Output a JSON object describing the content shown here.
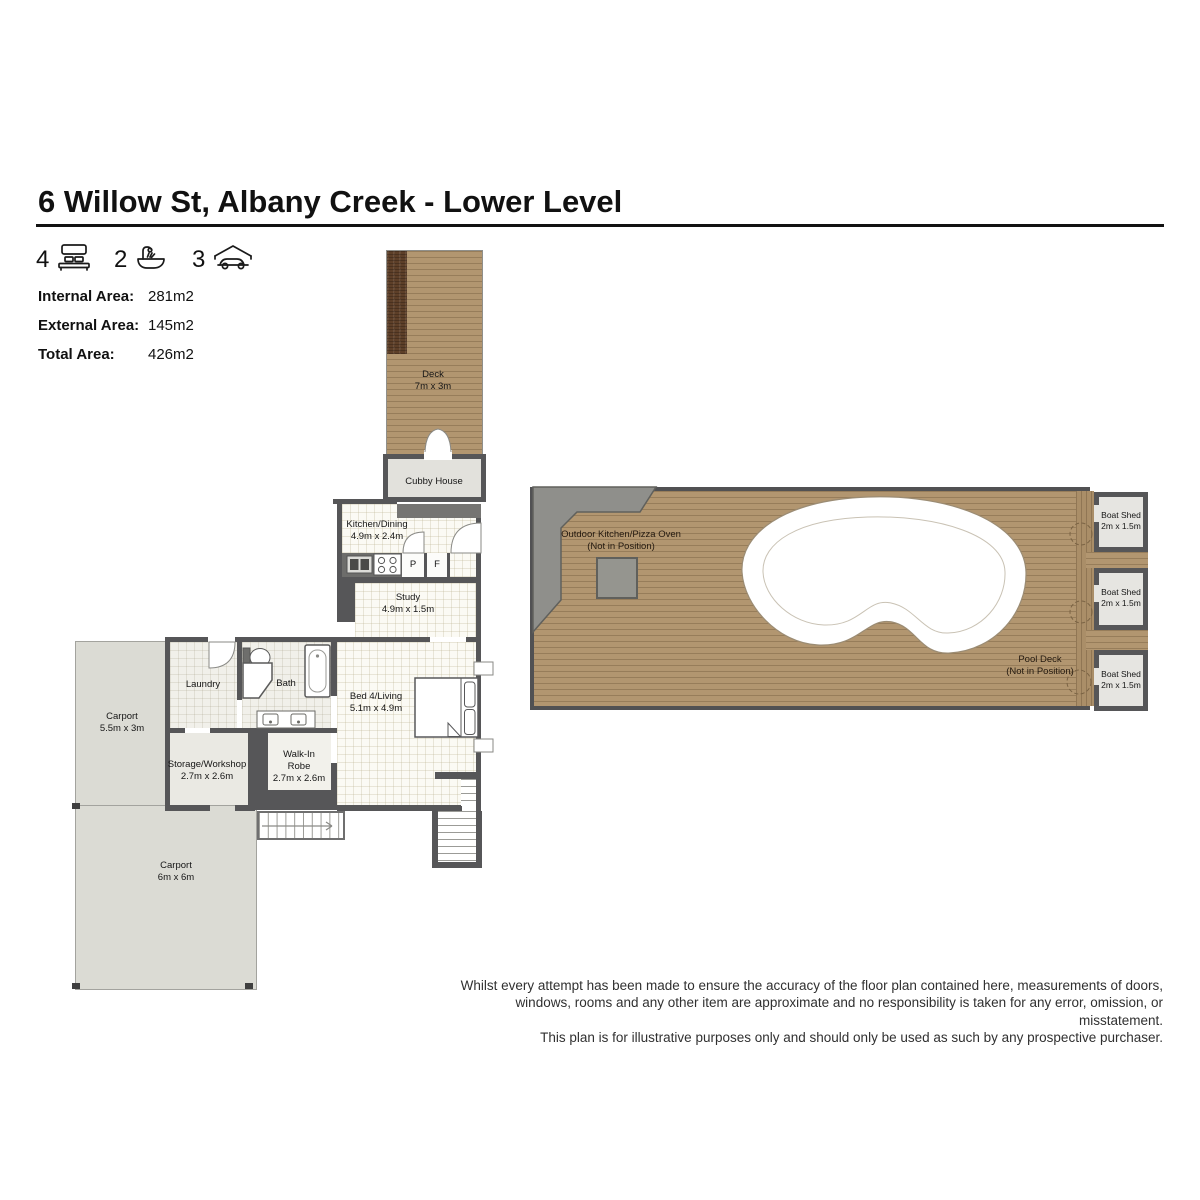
{
  "header": {
    "title": "6 Willow St, Albany Creek - Lower Level"
  },
  "features": [
    {
      "count": "4",
      "type": "bedrooms"
    },
    {
      "count": "2",
      "type": "bathrooms"
    },
    {
      "count": "3",
      "type": "car-spaces"
    }
  ],
  "areas": [
    {
      "label": "Internal Area:",
      "value": "281m2"
    },
    {
      "label": "External Area:",
      "value": "145m2"
    },
    {
      "label": "Total Area:",
      "value": "426m2"
    }
  ],
  "rooms": {
    "deck": {
      "name": "Deck",
      "dims": "7m x 3m"
    },
    "cubby_house": {
      "name": "Cubby House"
    },
    "kitchen_dining": {
      "name": "Kitchen/Dining",
      "dims": "4.9m x 2.4m"
    },
    "pantry_label": "P",
    "fridge_label": "F",
    "study": {
      "name": "Study",
      "dims": "4.9m x 1.5m"
    },
    "laundry": {
      "name": "Laundry"
    },
    "bath": {
      "name": "Bath"
    },
    "carport_upper": {
      "name": "Carport",
      "dims": "5.5m x 3m"
    },
    "storage_workshop": {
      "name": "Storage/Workshop",
      "dims": "2.7m x 2.6m"
    },
    "walk_in_robe": {
      "name": "Walk-In Robe",
      "dims": "2.7m x 2.6m"
    },
    "bed4_living": {
      "name": "Bed 4/Living",
      "dims": "5.1m x 4.9m"
    },
    "carport_lower": {
      "name": "Carport",
      "dims": "6m x 6m"
    },
    "outdoor_kitchen": {
      "name": "Outdoor Kitchen/Pizza Oven",
      "note": "(Not in Position)"
    },
    "pool_deck": {
      "name": "Pool Deck",
      "note": "(Not in Position)"
    },
    "boat_sheds": [
      {
        "name": "Boat Shed",
        "dims": "2m x 1.5m"
      },
      {
        "name": "Boat Shed",
        "dims": "2m x 1.5m"
      },
      {
        "name": "Boat Shed",
        "dims": "2m x 1.5m"
      }
    ]
  },
  "disclaimer": {
    "line1": "Whilst every attempt has been made to ensure the accuracy of the floor plan contained here, measurements of doors,",
    "line2": "windows, rooms and any other item are approximate and no responsibility is taken for any error, omission, or misstatement.",
    "line3": "This plan is for illustrative purposes only and should only be used as such by any prospective purchaser."
  },
  "colors": {
    "deck_brown": "#b29670",
    "dark_timber": "#5d3f28",
    "wall_gray": "#565658",
    "carport_gray": "#dbdbd4"
  }
}
